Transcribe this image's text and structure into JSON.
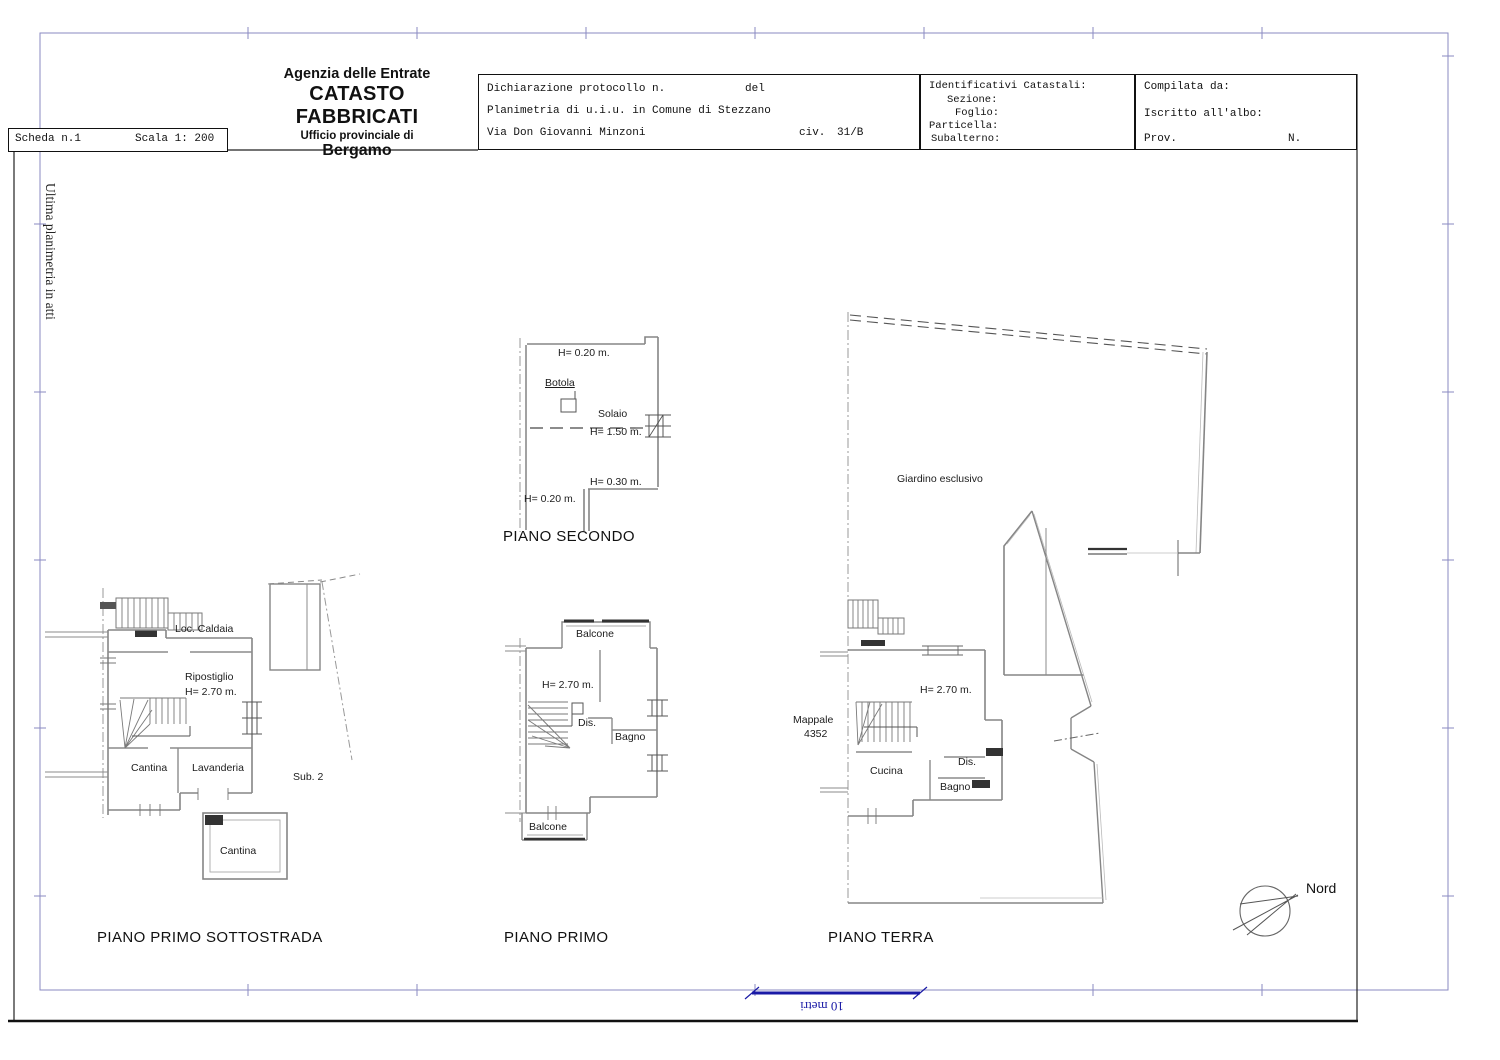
{
  "page": {
    "scheda_label": "Scheda n.1",
    "scala_label": "Scala 1: 200",
    "margin_note": "Ultima planimetria in atti"
  },
  "agency_header": {
    "line1": "Agenzia delle Entrate",
    "line2": "CATASTO FABBRICATI",
    "line3": "Ufficio provinciale di",
    "line4": "Bergamo"
  },
  "declaration_box": {
    "protocol_label": "Dichiarazione protocollo n.",
    "protocol_del": "del",
    "planimetria_line": "Planimetria di u.i.u. in Comune di Stezzano",
    "street": "Via Don Giovanni Minzoni",
    "civ_label": "civ.",
    "civ_value": "31/B"
  },
  "cadastral_box": {
    "title": "Identificativi Catastali:",
    "sezione": "Sezione:",
    "foglio": "Foglio:",
    "particella": "Particella:",
    "subalterno": "Subalterno:"
  },
  "compiler_box": {
    "compilata": "Compilata da:",
    "iscritto": "Iscritto all'albo:",
    "prov": "Prov.",
    "n": "N."
  },
  "plans": {
    "secondo": {
      "title": "PIANO SECONDO",
      "labels": {
        "h_top": "H= 0.20 m.",
        "botola": "Botola",
        "solaio": "Solaio",
        "h_mid": "H= 1.50 m.",
        "h_low": "H= 0.30 m.",
        "h_bottom": "H= 0.20 m."
      }
    },
    "sottostrada": {
      "title": "PIANO PRIMO SOTTOSTRADA",
      "labels": {
        "loc_caldaia": "Loc. Caldaia",
        "ripostiglio": "Ripostiglio",
        "h": "H= 2.70 m.",
        "cantina": "Cantina",
        "lavanderia": "Lavanderia",
        "sub2": "Sub. 2",
        "cantina_bassa": "Cantina"
      }
    },
    "primo": {
      "title": "PIANO PRIMO",
      "labels": {
        "balcone_top": "Balcone",
        "h": "H= 2.70 m.",
        "dis": "Dis.",
        "bagno": "Bagno",
        "balcone_bottom": "Balcone"
      }
    },
    "terra": {
      "title": "PIANO TERRA",
      "labels": {
        "giardino": "Giardino esclusivo",
        "mappale_1": "Mappale",
        "mappale_2": "4352",
        "h": "H= 2.70 m.",
        "cucina": "Cucina",
        "dis": "Dis.",
        "bagno": "Bagno"
      }
    }
  },
  "compass": {
    "label": "Nord"
  },
  "scalebar": {
    "label": "10 metri"
  }
}
